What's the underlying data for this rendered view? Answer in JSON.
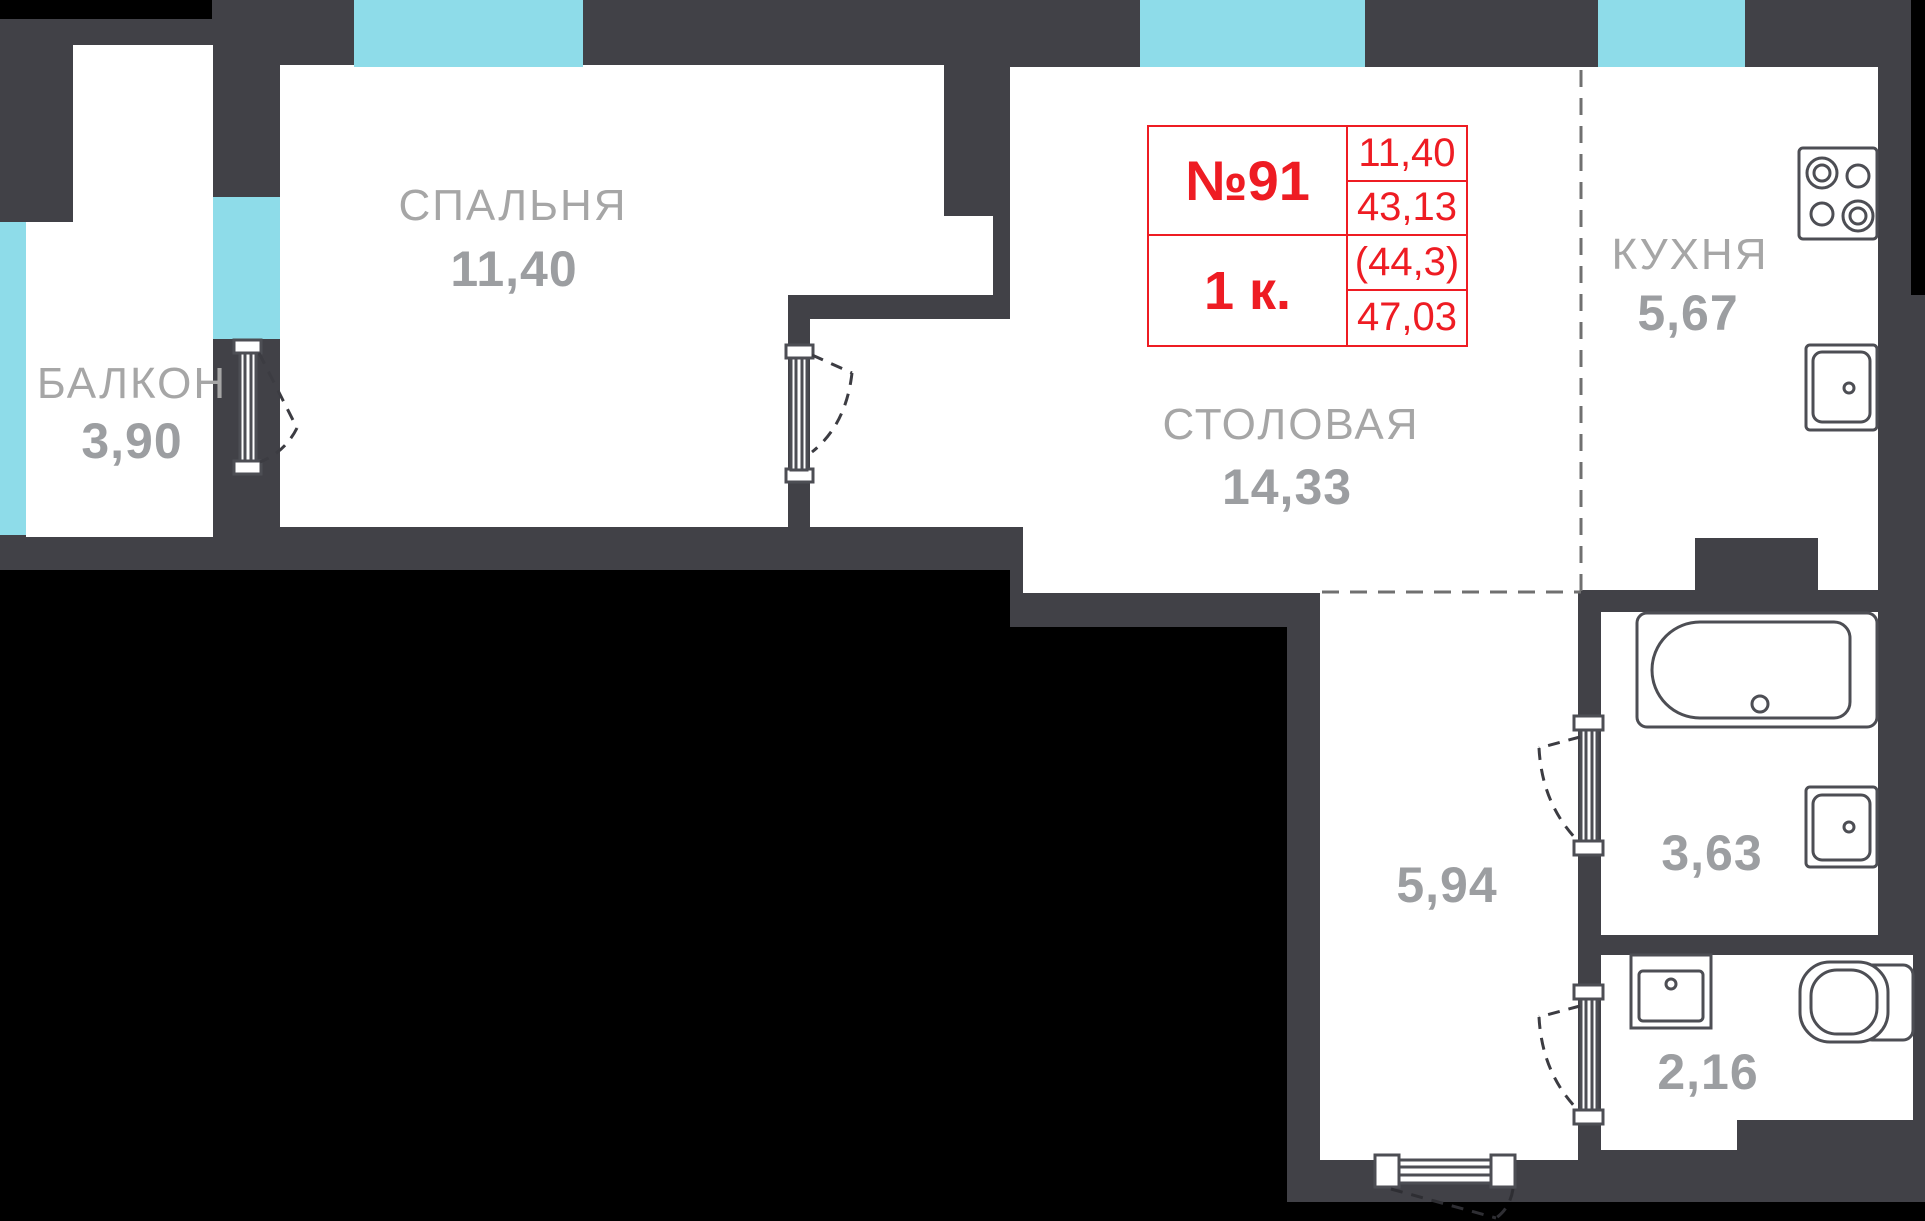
{
  "unit_card": {
    "number": "№91",
    "type": "1 к.",
    "metrics": [
      "11,40",
      "43,13",
      "(44,3)",
      "47,03"
    ]
  },
  "rooms": {
    "bedroom": {
      "name": "СПАЛЬНЯ",
      "area": "11,40"
    },
    "balcony": {
      "name": "БАЛКОН",
      "area": "3,90"
    },
    "dining": {
      "name": "СТОЛОВАЯ",
      "area": "14,33"
    },
    "kitchen": {
      "name": "КУХНЯ",
      "area": "5,67"
    },
    "hallway": {
      "area": "5,94"
    },
    "bathroom": {
      "area": "3,63"
    },
    "toilet": {
      "area": "2,16"
    }
  },
  "colors": {
    "wall": "#414147",
    "background": "#000000",
    "floor": "#ffffff",
    "window": "#8edce9",
    "accent_red": "#ee1c23",
    "label_gray": "#a6a6a6",
    "fixture_stroke": "#4d4e54"
  }
}
